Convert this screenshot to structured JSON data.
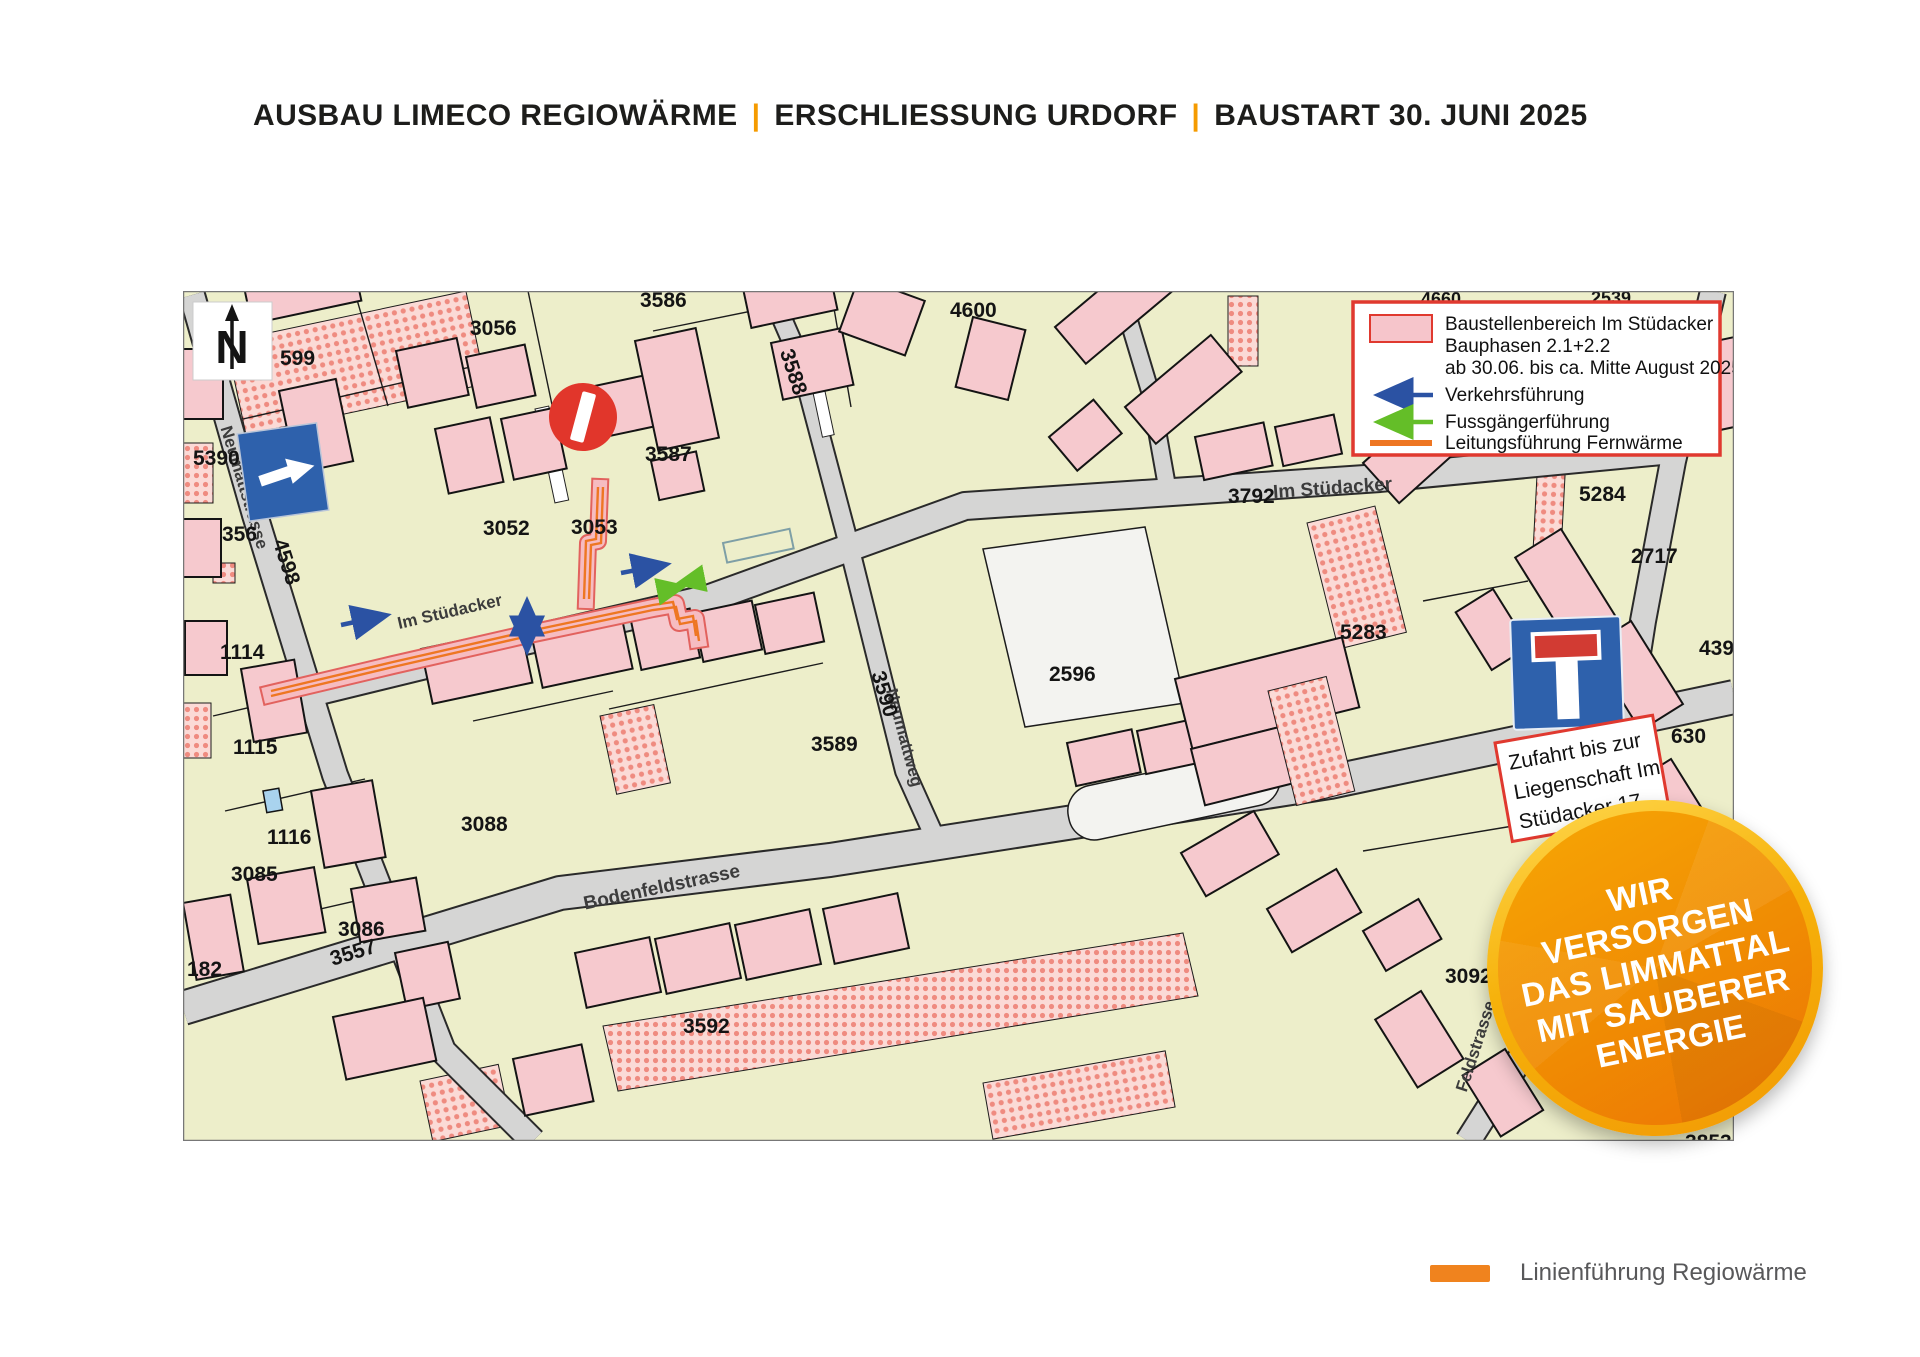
{
  "header": {
    "segments": [
      "AUSBAU LIMECO REGIOWÄRME",
      "ERSCHLIESSUNG URDORF",
      "BAUSTART 30. JUNI 2025"
    ],
    "separator": "|"
  },
  "colors": {
    "accent_orange": "#F59B00",
    "legend_border_red": "#E0392F",
    "construction_pink": "#F6C9CE",
    "traffic_blue": "#2B52A3",
    "pedestrian_green": "#64BE28",
    "pipe_orange": "#EE7622",
    "sign_blue": "#2E61AC",
    "no_entry_red": "#E1362B"
  },
  "map": {
    "north_label": "N",
    "legend": {
      "construction_lines": [
        "Baustellenbereich Im Stüdacker",
        "Bauphasen 2.1+2.2",
        "ab 30.06. bis ca. Mitte August 2025"
      ],
      "traffic": "Verkehrsführung",
      "pedestrian": "Fussgängerführung",
      "pipe": "Leitungsführung Fernwärme"
    },
    "access_note_lines": [
      "Zufahrt bis zur",
      "Liegenschaft Im",
      "Stüdacker 17"
    ],
    "street_labels": [
      "Neumattstrasse",
      "Im Stüdacker",
      "Im Stüdacker",
      "Bodenfeldstrasse",
      "Feldstrasse",
      "Neumattweg"
    ],
    "parcel_labels": [
      "3586",
      "3056",
      "599",
      "4600",
      "5390",
      "356",
      "4598",
      "3052",
      "3053",
      "3587",
      "3588",
      "3792",
      "1114",
      "1115",
      "1116",
      "3085",
      "3086",
      "182",
      "3557",
      "3088",
      "3589",
      "3590",
      "2596",
      "3592",
      "5283",
      "5284",
      "2717",
      "4392",
      "630",
      "3092",
      "3854",
      "3853",
      "4660",
      "2539"
    ]
  },
  "badge": {
    "lines": [
      "WIR",
      "VERSORGEN",
      "DAS LIMMATTAL",
      "MIT SAUBERER",
      "ENERGIE"
    ]
  },
  "footer_legend": {
    "label": "Linienführung Regiowärme"
  }
}
